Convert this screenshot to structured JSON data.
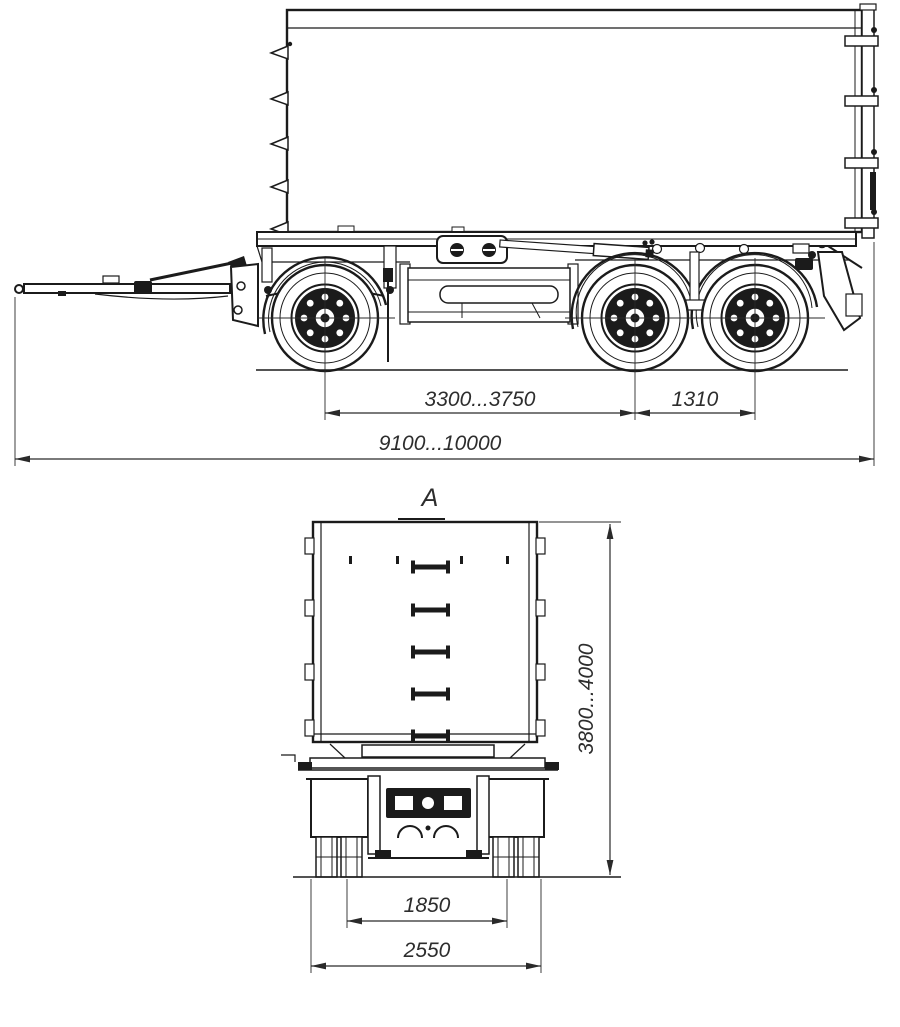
{
  "drawing": {
    "kind": "engineering-line-drawing",
    "subject": "three-axle drawbar tipper trailer, side view and rear view",
    "colors": {
      "line": "#1b1b1b",
      "dim_text": "#2d2d2d",
      "background": "#ffffff"
    },
    "side_view": {
      "name": "side view",
      "dim_axle_spacing": {
        "label": "3300...3750"
      },
      "dim_rear_axle_spacing": {
        "label": "1310"
      },
      "dim_overall_length": {
        "label": "9100...10000"
      }
    },
    "rear_view": {
      "name": "rear view",
      "view_label": "A",
      "dim_overall_height": {
        "label": "3800...4000"
      },
      "dim_track_width": {
        "label": "1850"
      },
      "dim_overall_width": {
        "label": "2550"
      }
    }
  }
}
